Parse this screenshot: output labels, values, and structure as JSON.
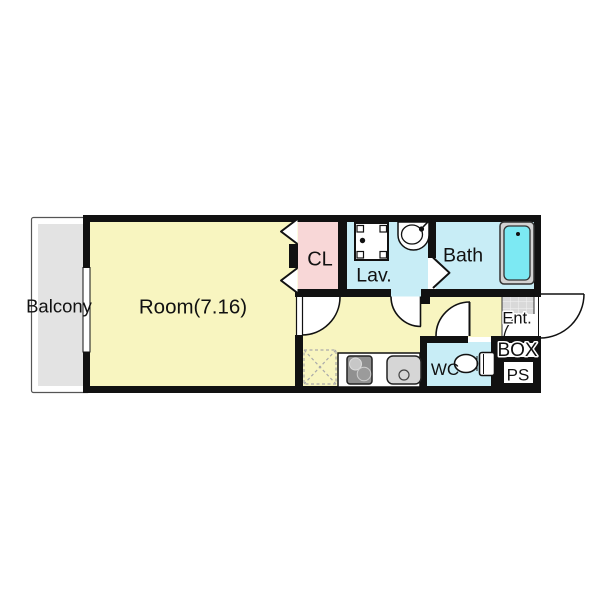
{
  "plan": {
    "labels": {
      "balcony": "Balcony",
      "room": "Room(7.16)",
      "closet": "CL",
      "lavatory": "Lav.",
      "bath": "Bath",
      "wc": "WC",
      "entrance": "Ent.",
      "box": "BOX",
      "pipe_space": "PS"
    },
    "room_area": "7.16",
    "colors": {
      "wall": "#111111",
      "room_fill": "#f8f5c0",
      "closet_fill": "#f8d7d7",
      "wet_area_fill": "#c8edf6",
      "bathtub_fill": "#7ce9f3",
      "balcony_fill": "#e3e3e3",
      "entrance_tile_fill": "#d9d9d9",
      "fixture_gray": "#d3d3d3"
    }
  }
}
